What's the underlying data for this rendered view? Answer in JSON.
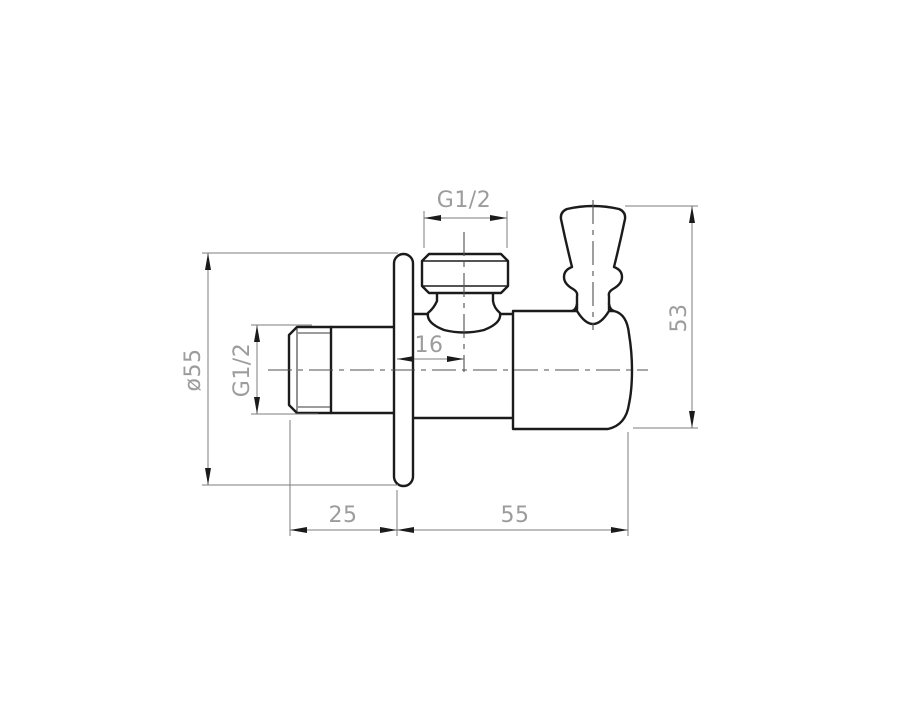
{
  "drawing": {
    "kind": "technical-drawing",
    "dimensions": {
      "top_thread_label": "G1/2",
      "inlet_thread_label": "G1/2",
      "flange_diameter_label": "ø55",
      "port_offset_label": "16",
      "overall_height_label": "53",
      "inlet_protrusion_label": "25",
      "body_length_label": "55"
    },
    "colors": {
      "outline": "#1b1b1b",
      "dimension_lines": "#7d7d7d",
      "dimension_text": "#9c9c9c",
      "background": "#ffffff"
    }
  }
}
